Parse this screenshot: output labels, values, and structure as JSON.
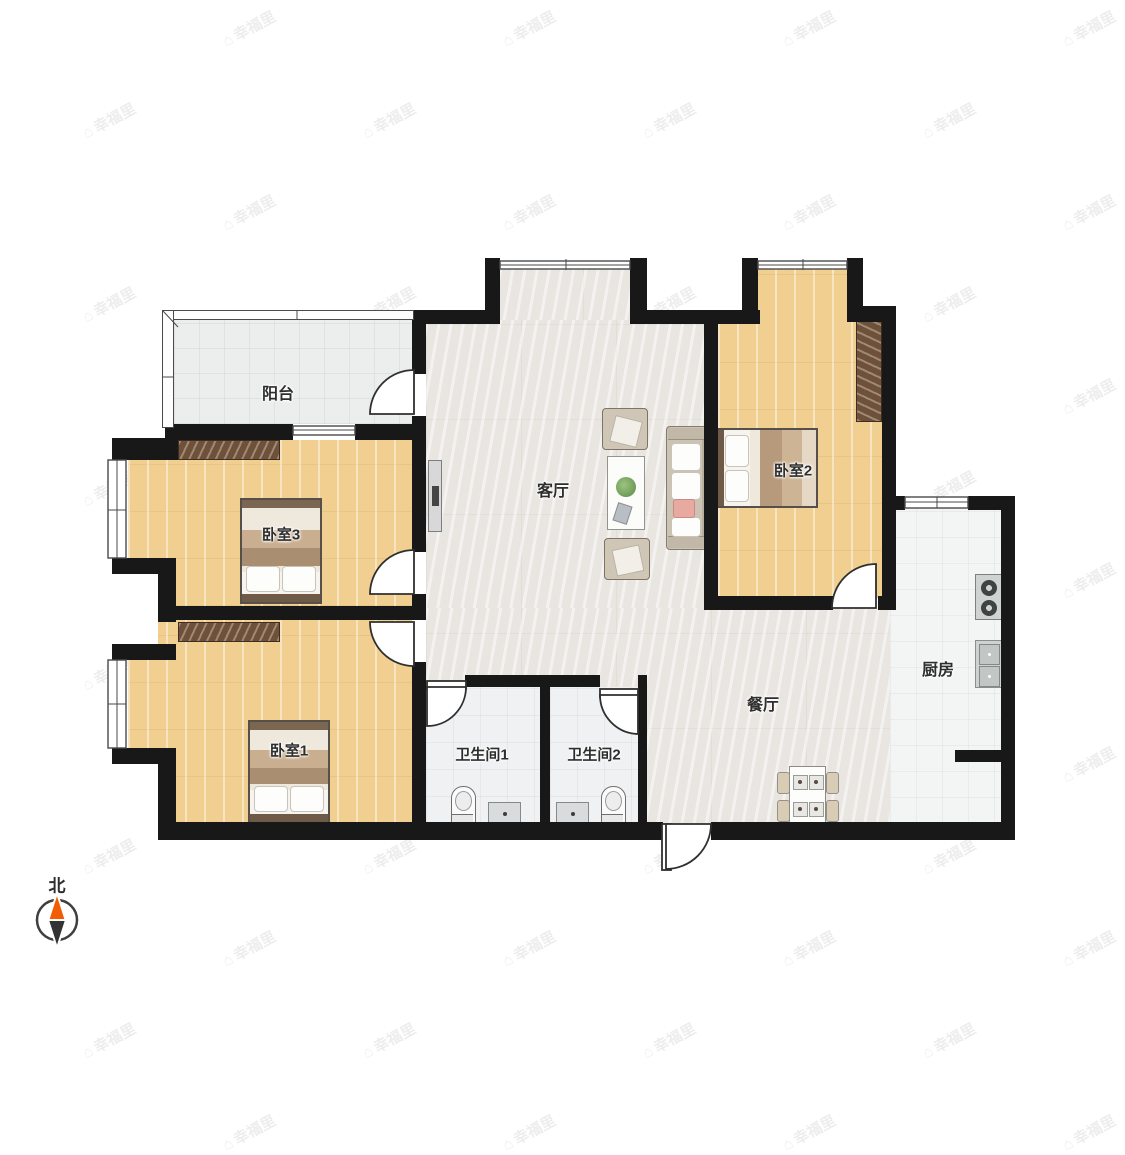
{
  "watermark": {
    "text": "幸福里",
    "icon": "house-icon"
  },
  "compass": {
    "label": "北",
    "needle_top_color": "#f25c05",
    "needle_bottom_color": "#333333"
  },
  "rooms": {
    "balcony": {
      "label": "阳台"
    },
    "bedroom3": {
      "label": "卧室3"
    },
    "bedroom1": {
      "label": "卧室1"
    },
    "bedroom2": {
      "label": "卧室2"
    },
    "living_room": {
      "label": "客厅"
    },
    "dining_room": {
      "label": "餐厅"
    },
    "kitchen": {
      "label": "厨房"
    },
    "bathroom1": {
      "label": "卫生间1"
    },
    "bathroom2": {
      "label": "卫生间2"
    }
  },
  "colors": {
    "wall": "#181818",
    "wood_floor": "#f0cf90",
    "marble_floor": "#e9e5e1",
    "tile_floor": "#eff1f2",
    "wardrobe": "#6e5138",
    "compass_orange": "#f25c05"
  }
}
